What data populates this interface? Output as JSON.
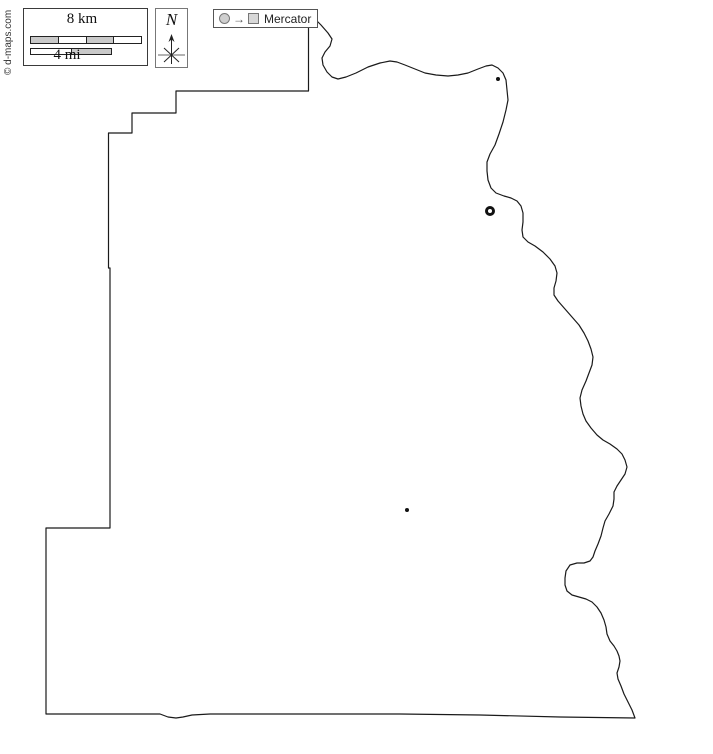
{
  "credit": {
    "text": "© d-maps.com"
  },
  "scale_box": {
    "km_label": "8 km",
    "mi_label": "4 mi"
  },
  "compass": {
    "label": "N"
  },
  "projection_box": {
    "arrow": "→",
    "label": "Mercator"
  },
  "map": {
    "markers": [
      {
        "type": "town-dot",
        "x": 498,
        "y": 79,
        "r": 2
      },
      {
        "type": "city-ring",
        "x": 490,
        "y": 211,
        "r": 3.5
      },
      {
        "type": "town-dot",
        "x": 407,
        "y": 510,
        "r": 2
      }
    ],
    "colors": {
      "outline": "#1a1a1a",
      "fill": "#ffffff",
      "scalebar_gray": "#c9c9c9",
      "symbol_border_gray": "#777777",
      "symbol_fill_gray": "#d8d8d8",
      "marker_black": "#111111"
    }
  }
}
